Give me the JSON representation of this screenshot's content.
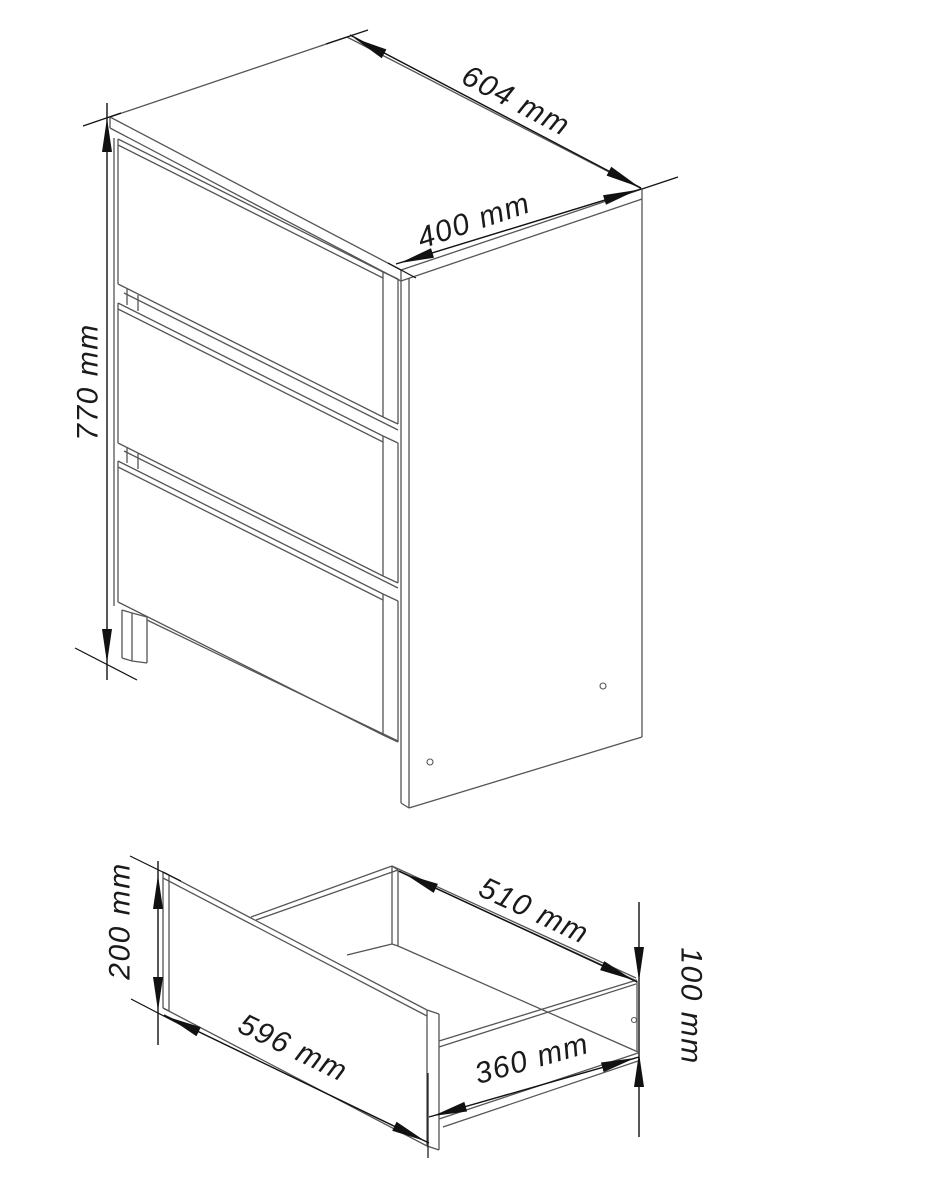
{
  "page": {
    "background": "#ffffff",
    "title": "Chest of drawers dimension drawing"
  },
  "diagram": {
    "canvas": {
      "width": 937,
      "height": 1200
    },
    "structure_color": "#555555",
    "dimension_color": "#111111",
    "structure_width": 1.3,
    "dimension_width": 1.4,
    "arrow_length": 34,
    "arrow_half_width": 5,
    "views": [
      {
        "name": "cabinet-isometric-view",
        "segments": [
          [
            110,
            117,
            347,
            37
          ],
          [
            347,
            37,
            642,
            189
          ],
          [
            642,
            189,
            401,
            270
          ],
          [
            401,
            270,
            110,
            117
          ],
          [
            110,
            117,
            110,
            128
          ],
          [
            110,
            128,
            401,
            281
          ],
          [
            401,
            270,
            401,
            281
          ],
          [
            401,
            281,
            642,
            199
          ],
          [
            642,
            189,
            642,
            199
          ],
          [
            114,
            138,
            114,
            606
          ],
          [
            118,
            139,
            383,
            272
          ],
          [
            118,
            145,
            383,
            278
          ],
          [
            118,
            139,
            118,
            284
          ],
          [
            118,
            284,
            383,
            417
          ],
          [
            383,
            272,
            383,
            417
          ],
          [
            383,
            272,
            398,
            279
          ],
          [
            398,
            279,
            398,
            424
          ],
          [
            383,
            417,
            398,
            424
          ],
          [
            124,
            293,
            398,
            430
          ],
          [
            127,
            289,
            127,
            305
          ],
          [
            138,
            295,
            138,
            311
          ],
          [
            118,
            303,
            383,
            436
          ],
          [
            118,
            309,
            383,
            442
          ],
          [
            118,
            303,
            118,
            443
          ],
          [
            118,
            443,
            383,
            576
          ],
          [
            383,
            436,
            383,
            576
          ],
          [
            383,
            436,
            398,
            443
          ],
          [
            398,
            443,
            398,
            583
          ],
          [
            383,
            576,
            398,
            583
          ],
          [
            124,
            451,
            398,
            588
          ],
          [
            127,
            447,
            127,
            463
          ],
          [
            138,
            453,
            138,
            469
          ],
          [
            118,
            461,
            383,
            594
          ],
          [
            118,
            467,
            383,
            600
          ],
          [
            118,
            461,
            118,
            602
          ],
          [
            118,
            602,
            383,
            735
          ],
          [
            383,
            594,
            383,
            735
          ],
          [
            383,
            594,
            398,
            601
          ],
          [
            398,
            601,
            398,
            742
          ],
          [
            383,
            735,
            398,
            742
          ],
          [
            122,
            610,
            122,
            658
          ],
          [
            122,
            610,
            132,
            613
          ],
          [
            132,
            613,
            132,
            661
          ],
          [
            122,
            658,
            132,
            661
          ],
          [
            132,
            613,
            147,
            617
          ],
          [
            147,
            617,
            147,
            663
          ],
          [
            132,
            661,
            147,
            663
          ],
          [
            147,
            620,
            398,
            741
          ],
          [
            401,
            281,
            401,
            803
          ],
          [
            409,
            278,
            409,
            808
          ],
          [
            401,
            803,
            409,
            808
          ],
          [
            409,
            808,
            642,
            737
          ],
          [
            642,
            199,
            642,
            737
          ]
        ],
        "circles": [
          [
            603,
            686,
            3
          ],
          [
            430,
            762,
            3
          ]
        ]
      },
      {
        "name": "drawer-detail-view",
        "segments": [
          [
            163,
            872,
            427,
            1010
          ],
          [
            163,
            878,
            427,
            1016
          ],
          [
            163,
            872,
            163,
            1008
          ],
          [
            169,
            875,
            169,
            1011
          ],
          [
            163,
            872,
            169,
            875
          ],
          [
            163,
            1008,
            169,
            1011
          ],
          [
            163,
            1008,
            427,
            1146
          ],
          [
            427,
            1010,
            427,
            1146
          ],
          [
            427,
            1010,
            439,
            1014
          ],
          [
            439,
            1014,
            439,
            1150
          ],
          [
            427,
            1146,
            439,
            1150
          ],
          [
            251,
            917,
            392,
            866
          ],
          [
            256,
            920,
            398,
            870
          ],
          [
            392,
            866,
            392,
            944
          ],
          [
            398,
            870,
            398,
            946
          ],
          [
            392,
            866,
            398,
            870
          ],
          [
            392,
            944,
            398,
            946
          ],
          [
            392,
            866,
            636,
            978
          ],
          [
            398,
            871,
            637,
            981
          ],
          [
            398,
            946,
            638,
            1052
          ],
          [
            347,
            955,
            392,
            944
          ],
          [
            637,
            981,
            637,
            1052
          ],
          [
            439,
            1041,
            637,
            980
          ],
          [
            439,
            1047,
            636,
            984
          ],
          [
            439,
            1119,
            638,
            1053
          ],
          [
            443,
            1127,
            638,
            1061
          ]
        ],
        "circles": [
          [
            634,
            1020,
            2.5
          ]
        ]
      }
    ],
    "dimensions": [
      {
        "id": "cabinet-height",
        "label": "770 mm",
        "value": 770,
        "unit": "mm",
        "line": [
          107,
          103,
          107,
          680
        ],
        "arrows": [
          [
            107,
            118,
            -90
          ],
          [
            107,
            663,
            90
          ]
        ],
        "extensions": [
          [
            83,
            126,
            121,
            113
          ],
          [
            75,
            648,
            137,
            680
          ]
        ],
        "label_pos": [
          88,
          382
        ],
        "label_rot": -90
      },
      {
        "id": "cabinet-width",
        "label": "604 mm",
        "value": 604,
        "unit": "mm",
        "line": [
          350,
          35,
          641,
          188
        ],
        "arrows": [
          [
            354,
            38,
            207.8
          ],
          [
            639,
            187,
            27.8
          ]
        ],
        "extensions": [
          [
            326,
            44,
            368,
            30
          ],
          [
            642,
            189,
            678,
            177
          ]
        ],
        "label_pos": [
          516,
          101
        ],
        "label_rot": 27.7
      },
      {
        "id": "cabinet-depth",
        "label": "400 mm",
        "value": 400,
        "unit": "mm",
        "line": [
          396,
          264,
          641,
          189
        ],
        "arrows": [
          [
            400,
            263,
            162.9
          ],
          [
            637,
            190,
            -17.1
          ]
        ],
        "extensions": [
          [
            388,
            263,
            416,
            278
          ]
        ],
        "label_pos": [
          474,
          221
        ],
        "label_rot": -18.7
      },
      {
        "id": "drawer-front-height",
        "label": "200 mm",
        "value": 200,
        "unit": "mm",
        "line": [
          158,
          861,
          158,
          1045
        ],
        "arrows": [
          [
            158,
            875,
            -90
          ],
          [
            158,
            1011,
            90
          ]
        ],
        "extensions": [
          [
            130,
            856,
            181,
            881
          ],
          [
            131,
            999,
            183,
            1026
          ]
        ],
        "label_pos": [
          120,
          921
        ],
        "label_rot": -90
      },
      {
        "id": "drawer-front-width",
        "label": "596 mm",
        "value": 596,
        "unit": "mm",
        "line": [
          164,
          1015,
          429,
          1143
        ],
        "arrows": [
          [
            168,
            1017,
            205.8
          ],
          [
            425,
            1141,
            25.8
          ]
        ],
        "extensions": [
          [
            428,
            1073,
            428,
            1158
          ]
        ],
        "label_pos": [
          293,
          1048
        ],
        "label_rot": 25.8
      },
      {
        "id": "drawer-box-width",
        "label": "510 mm",
        "value": 510,
        "unit": "mm",
        "line": [
          399,
          871,
          637,
          982
        ],
        "arrows": [
          [
            405,
            874,
            205
          ],
          [
            633,
            980,
            25
          ]
        ],
        "extensions": [],
        "label_pos": [
          534,
          911
        ],
        "label_rot": 25
      },
      {
        "id": "drawer-box-depth",
        "label": "360 mm",
        "value": 360,
        "unit": "mm",
        "line": [
          429,
          1117,
          639,
          1057
        ],
        "arrows": [
          [
            433,
            1116,
            164.1
          ],
          [
            635,
            1058,
            -15.9
          ]
        ],
        "extensions": [],
        "label_pos": [
          532,
          1059
        ],
        "label_rot": -15.9
      },
      {
        "id": "drawer-box-height",
        "label": "100 mm",
        "value": 100,
        "unit": "mm",
        "line": [
          639,
          902,
          639,
          1137
        ],
        "arrows": [
          [
            639,
            981,
            90
          ],
          [
            639,
            1053,
            -90
          ]
        ],
        "extensions": [],
        "label_pos": [
          691,
          1006
        ],
        "label_rot": 90
      }
    ]
  }
}
